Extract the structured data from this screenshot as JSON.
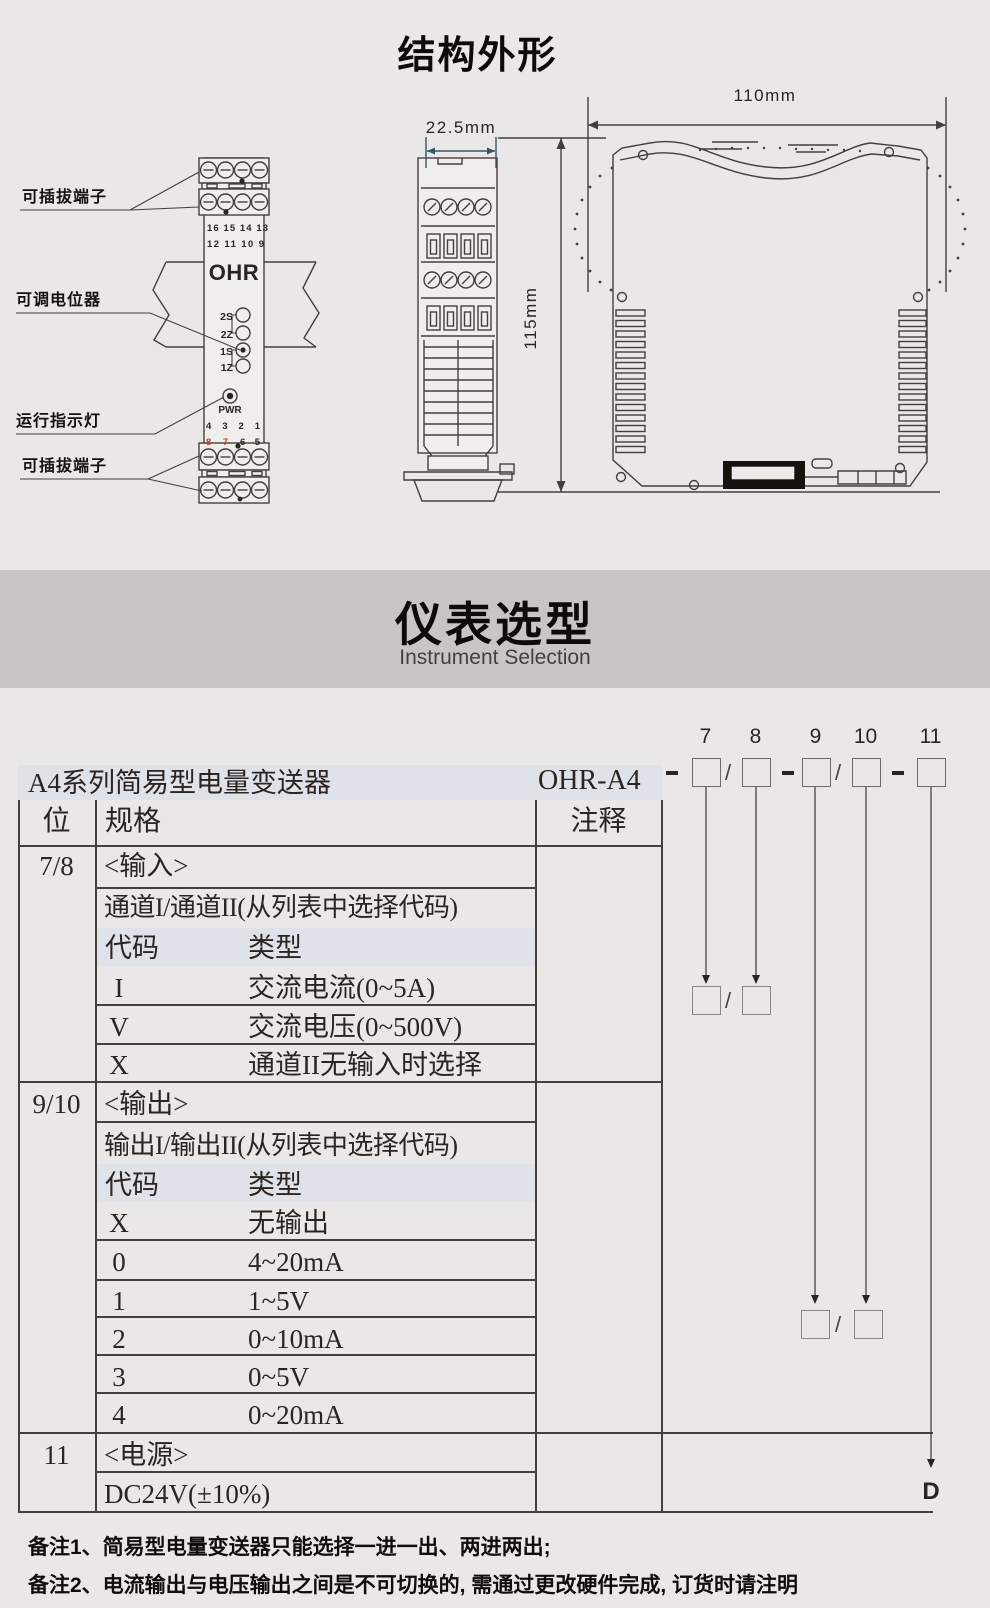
{
  "colors": {
    "page_bg": "#e9e7e7",
    "banner_bg": "#c8c5c5",
    "band_bg": "#dfe2e9",
    "line": "#463e3b",
    "text": "#2b2420",
    "red": "#c43b33"
  },
  "structure": {
    "title": "结构外形",
    "labels": {
      "terminal_top": "可插拔端子",
      "potentiometer": "可调电位器",
      "run_indicator": "运行指示灯",
      "terminal_bottom": "可插拔端子"
    },
    "front": {
      "logo": "OHR",
      "top_row1": "16 15 14 13",
      "top_row2": "12 11 10 9",
      "pot1": "2S",
      "pot2": "2Z",
      "pot3": "1S",
      "pot4": "1Z",
      "pwr": "PWR",
      "bot_row1": "4 3 2 1",
      "bot_row2_red": "8 7",
      "bot_row2_black": "6 5"
    },
    "dims": {
      "width_side": "22.5mm",
      "height": "115mm",
      "width_profile": "110mm"
    }
  },
  "banner": {
    "title": "仪表选型",
    "subtitle": "Instrument Selection"
  },
  "selection": {
    "series_title": "A4系列简易型电量变送器",
    "model_prefix": "OHR-A4",
    "digits": [
      "7",
      "8",
      "9",
      "10",
      "11"
    ],
    "slash": "/",
    "suffix": "D",
    "table": {
      "col_pos": "位",
      "col_spec": "规格",
      "col_note": "注释",
      "sections": [
        {
          "pos": "7/8",
          "title": "<输入>",
          "subtitle": "通道I/通道II(从列表中选择代码)",
          "code_label": "代码",
          "type_label": "类型",
          "rows": [
            {
              "code": "I",
              "type": "交流电流(0~5A)"
            },
            {
              "code": "V",
              "type": "交流电压(0~500V)"
            },
            {
              "code": "X",
              "type": "通道II无输入时选择"
            }
          ]
        },
        {
          "pos": "9/10",
          "title": "<输出>",
          "subtitle": "输出I/输出II(从列表中选择代码)",
          "code_label": "代码",
          "type_label": "类型",
          "rows": [
            {
              "code": "X",
              "type": "无输出"
            },
            {
              "code": "0",
              "type": "4~20mA"
            },
            {
              "code": "1",
              "type": "1~5V"
            },
            {
              "code": "2",
              "type": "0~10mA"
            },
            {
              "code": "3",
              "type": "0~5V"
            },
            {
              "code": "4",
              "type": "0~20mA"
            }
          ]
        },
        {
          "pos": "11",
          "title": "<电源>",
          "subtitle": "DC24V(±10%)"
        }
      ]
    },
    "notes": [
      "备注1、简易型电量变送器只能选择一进一出、两进两出;",
      "备注2、电流输出与电压输出之间是不可切换的, 需通过更改硬件完成, 订货时请注明"
    ]
  }
}
